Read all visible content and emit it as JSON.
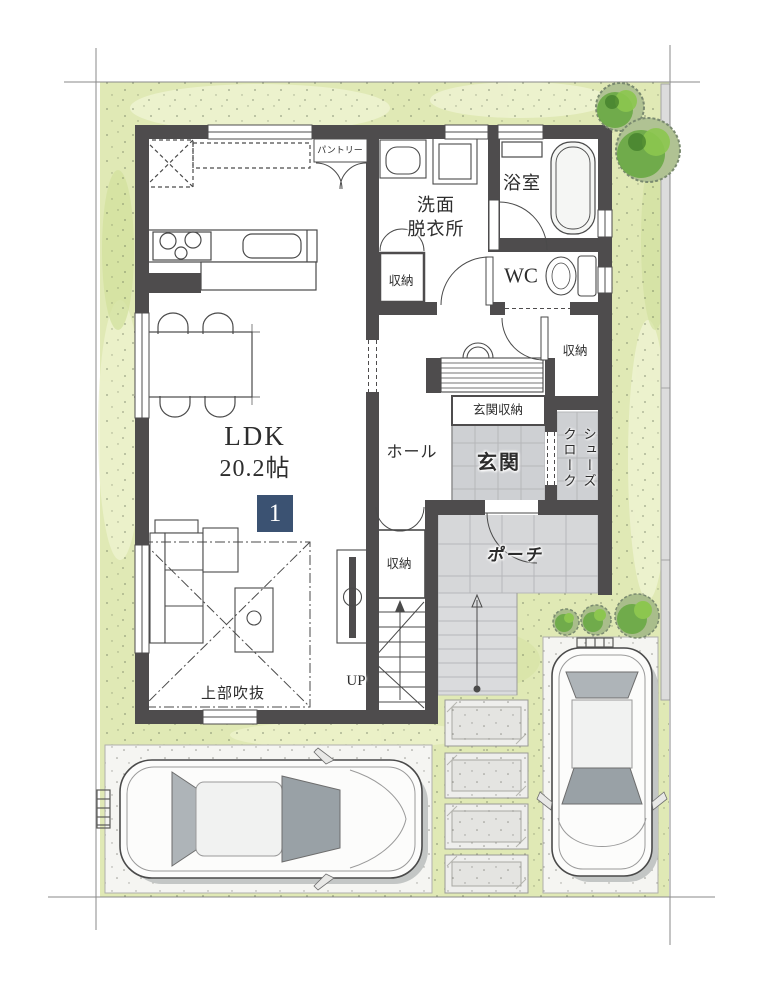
{
  "floorplan": {
    "unit_number": "1",
    "labels": {
      "pantry": "パントリー",
      "washroom_line1": "洗面",
      "washroom_line2": "脱衣所",
      "bath": "浴室",
      "wc": "WC",
      "storage_washroom": "収納",
      "storage_hall": "収納",
      "storage_stairs": "収納",
      "hall": "ホール",
      "genkan": "玄関",
      "genkan_storage": "玄関収納",
      "shoes_cloak_line1": "シューズ",
      "shoes_cloak_line2": "クローク",
      "porch": "ポーチ",
      "ldk_name": "LDK",
      "ldk_size": "20.2帖",
      "void_above": "上部吹抜",
      "stairs_up": "UP"
    },
    "colors": {
      "wall": "#4e4c4d",
      "lawn": "#e0e9b5",
      "tile": "#d2d3d6",
      "concrete": "#f5f5f2",
      "badge": "#3b5272",
      "text": "#2d2d2d",
      "tree": "#69a844"
    }
  }
}
